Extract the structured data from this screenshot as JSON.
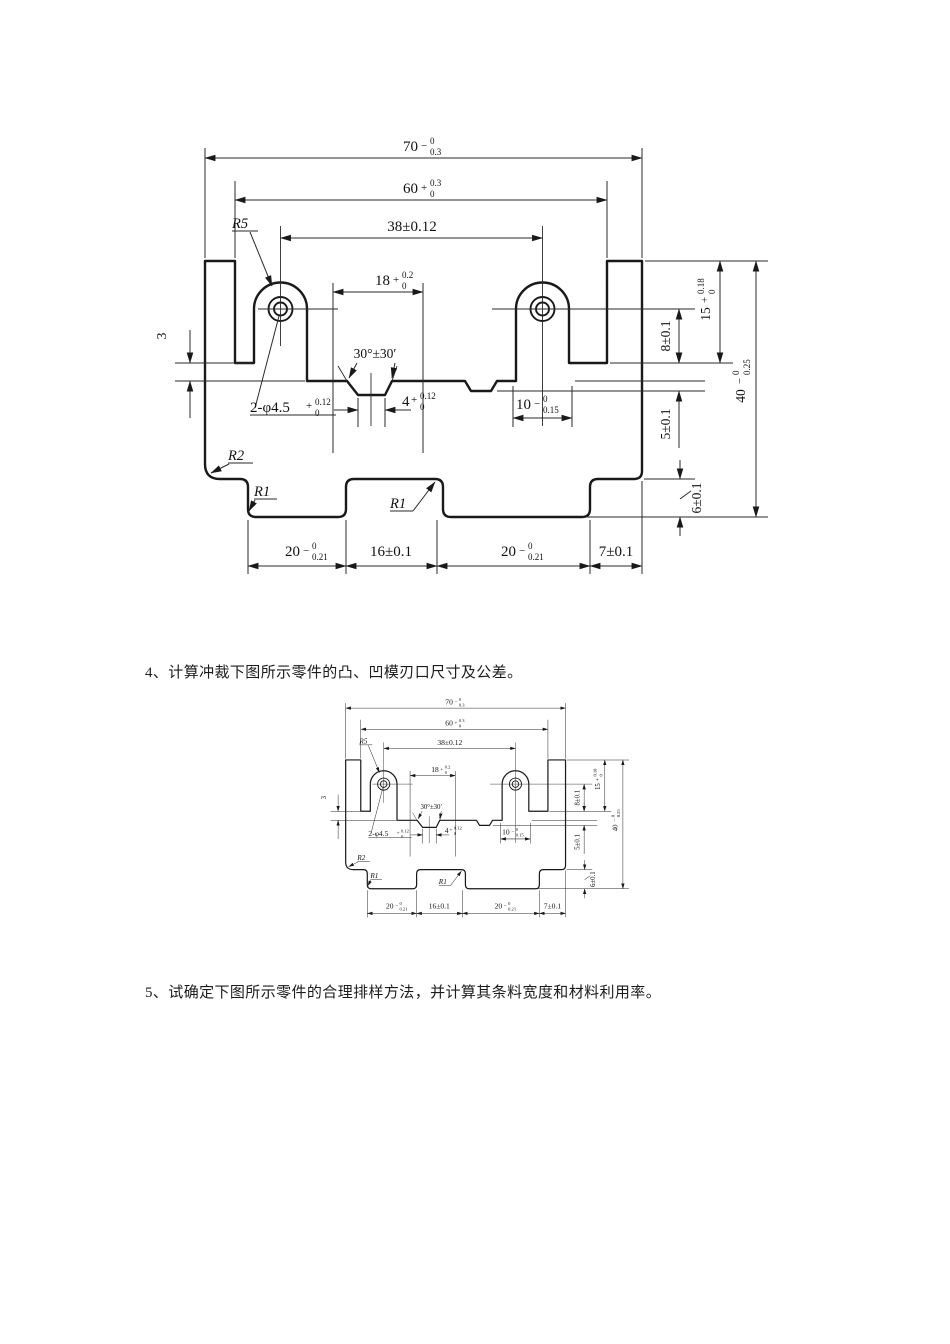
{
  "page": {
    "background": "#ffffff",
    "ink": "#191919"
  },
  "questions": {
    "q4": "4、计算冲裁下图所示零件的凸、凹模刃口尺寸及公差。",
    "q5": "5、试确定下图所示零件的合理排样方法，并计算其条料宽度和材料利用率。"
  },
  "drawing": {
    "dims": {
      "w70": {
        "value": "70",
        "sign": "−",
        "sup": "0",
        "sub": "0.3"
      },
      "w60": {
        "value": "60",
        "sign": "+",
        "sup": "0.3",
        "sub": "0"
      },
      "w38": {
        "value": "38±0.12"
      },
      "w18": {
        "value": "18",
        "sign": "+",
        "sup": "0.2",
        "sub": "0"
      },
      "r5": {
        "value": "R5"
      },
      "angle": {
        "value": "30°±30′"
      },
      "holes": {
        "value": "2-φ4.5",
        "sign": "+",
        "sup": "0.12",
        "sub": "0"
      },
      "w4": {
        "value": "4",
        "sign": "+",
        "sup": "0.12",
        "sub": "0"
      },
      "w10": {
        "value": "10",
        "sign": "−",
        "sup": "0",
        "sub": "0.15"
      },
      "h8": {
        "value": "8±0.1"
      },
      "h15": {
        "value": "15",
        "sign": "+",
        "sup": "0.18",
        "sub": "0"
      },
      "h40": {
        "value": "40",
        "sign": "−",
        "sup": "0",
        "sub": "0.25"
      },
      "h5": {
        "value": "5±0.1"
      },
      "h6": {
        "value": "6±0.1"
      },
      "h3": {
        "value": "3"
      },
      "r2": {
        "value": "R2"
      },
      "r1a": {
        "value": "R1"
      },
      "r1b": {
        "value": "R1"
      },
      "b20a": {
        "value": "20",
        "sign": "−",
        "sup": "0",
        "sub": "0.21"
      },
      "b16": {
        "value": "16±0.1"
      },
      "b20b": {
        "value": "20",
        "sign": "−",
        "sup": "0",
        "sub": "0.21"
      },
      "b7": {
        "value": "7±0.1"
      }
    }
  }
}
